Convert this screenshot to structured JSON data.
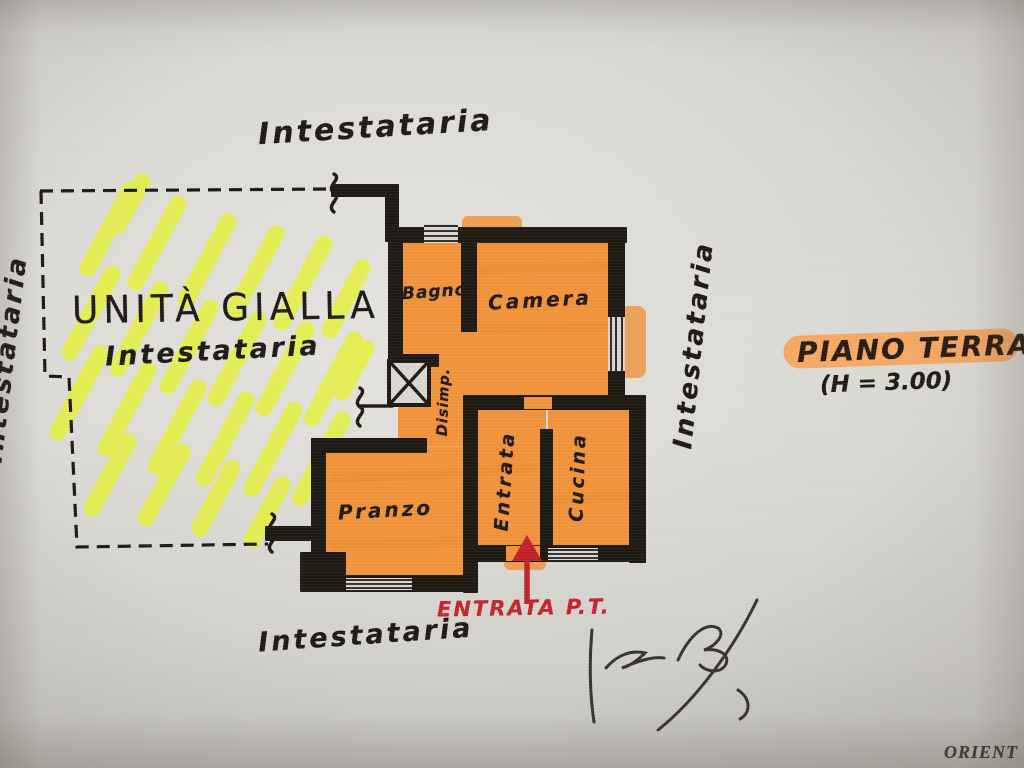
{
  "document": {
    "intestataria_top": "Intestataria",
    "intestataria_bottom": "Intestataria",
    "intestataria_right": "Intestataria",
    "intestataria_left_partial": "Intestataria",
    "orientation_corner": "ORIENT"
  },
  "yellow_unit": {
    "title": "UNITÀ GIALLA",
    "owner": "Intestataria"
  },
  "rooms": {
    "bagno": "Bagno",
    "camera": "Camera",
    "disimpegno": "Disimp.",
    "entrata": "Entrata",
    "cucina": "Cucina",
    "pranzo": "Pranzo"
  },
  "floor_note": {
    "title": "PIANO TERRA",
    "height": "(H = 3.00)"
  },
  "entrance": {
    "label": "ENTRATA P.T."
  },
  "colors": {
    "paper": "#d7d5d0",
    "ink": "#1e1913",
    "room_orange": "#ef9239",
    "highlight_orange": "#f7a45b",
    "highlight_yellow": "#e6f130",
    "annotation_red": "#c3242a"
  }
}
